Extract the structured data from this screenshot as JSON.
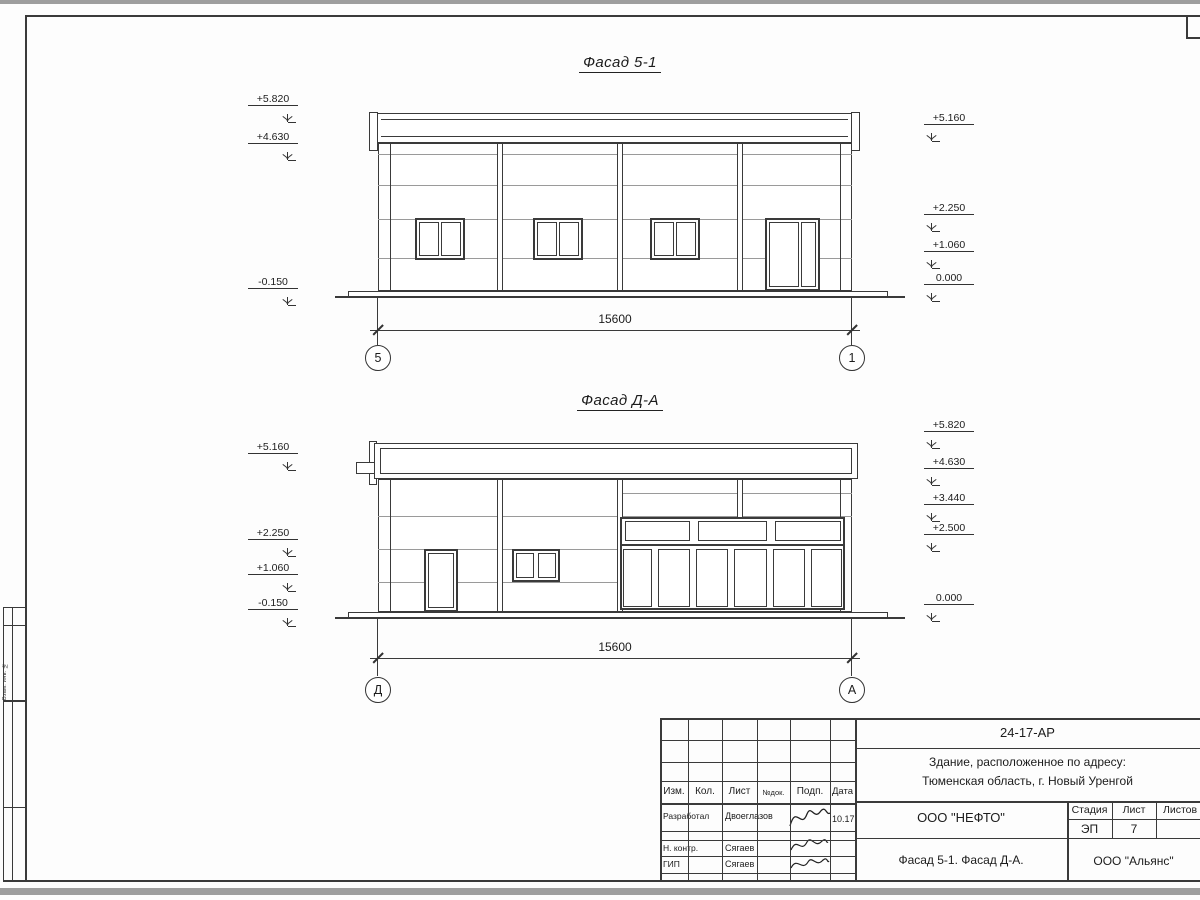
{
  "colors": {
    "line": "#3a3a3a",
    "thin_line": "#9a9a9a",
    "bar": "#9e9e9e"
  },
  "facade1": {
    "title": "Фасад 5-1",
    "marks_left": [
      "+5.820",
      "+4.630",
      "-0.150"
    ],
    "marks_right": [
      "+5.160",
      "+2.250",
      "+1.060",
      "0.000"
    ],
    "dimension": "15600",
    "axes": [
      "5",
      "1"
    ]
  },
  "facade2": {
    "title": "Фасад Д-А",
    "marks_left": [
      "+5.160",
      "+2.250",
      "+1.060",
      "-0.150"
    ],
    "marks_right": [
      "+5.820",
      "+4.630",
      "+3.440",
      "+2.500",
      "0.000"
    ],
    "dimension": "15600",
    "axes": [
      "Д",
      "А"
    ]
  },
  "side_strip": {
    "label": "Взам. инв. №"
  },
  "title_block": {
    "doc_number": "24-17-АР",
    "address_line1": "Здание, расположенное по адресу:",
    "address_line2": "Тюменская область, г. Новый Уренгой",
    "header_cols": [
      "Изм.",
      "Кол.",
      "Лист",
      "№док.",
      "Подп.",
      "Дата"
    ],
    "rows": [
      {
        "role": "Разработал",
        "name": "Двоеглазов",
        "date": "10.17"
      },
      {
        "role": "Н. контр.",
        "name": "Сягаев",
        "date": ""
      },
      {
        "role": "ГИП",
        "name": "Сягаев",
        "date": ""
      }
    ],
    "company": "ООО \"НЕФТО\"",
    "sheet_title": "Фасад 5-1. Фасад Д-А.",
    "stage_label": "Стадия",
    "stage_value": "ЭП",
    "sheet_label": "Лист",
    "sheet_value": "7",
    "sheets_label": "Листов",
    "contractor": "ООО \"Альянс\""
  }
}
